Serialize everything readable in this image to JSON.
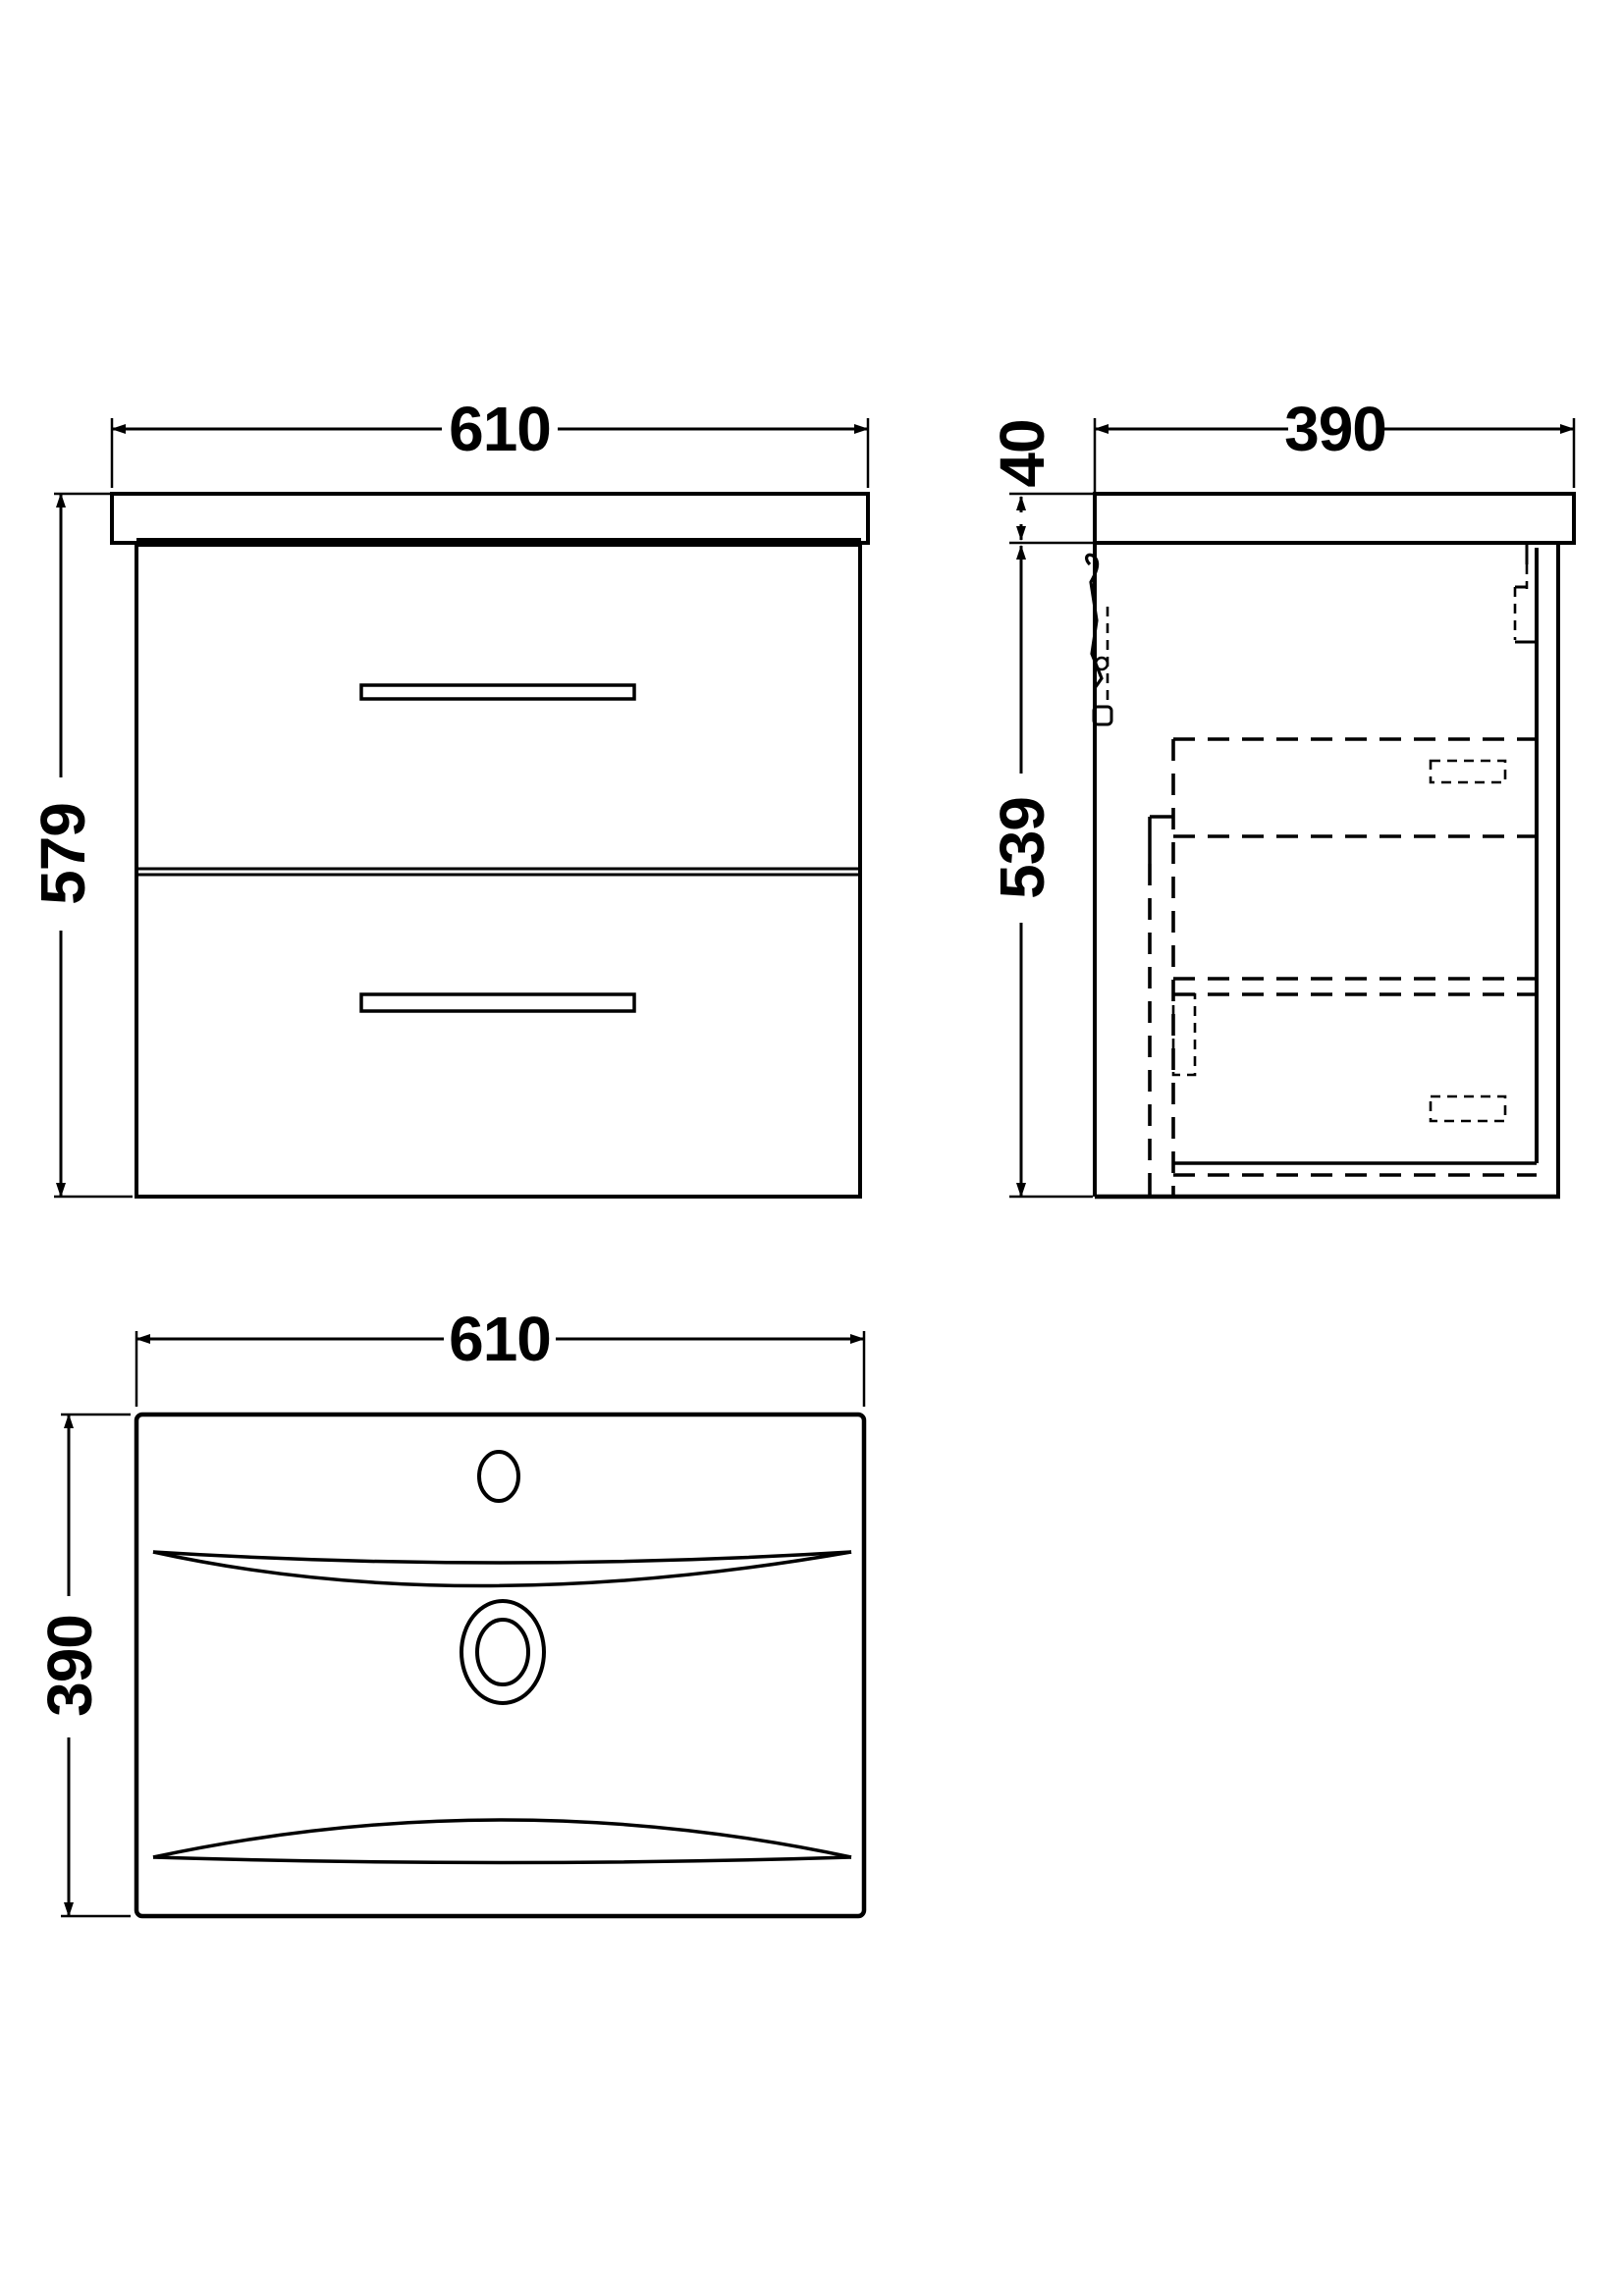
{
  "style": {
    "background_color": "#ffffff",
    "line_color": "#000000",
    "text_color": "#000000"
  },
  "drawing": {
    "description": "vanity-unit-technical-drawing",
    "front_view": {
      "width_mm": "610",
      "height_mm": "579"
    },
    "side_view": {
      "depth_mm": "390",
      "worktop_thickness_mm": "40",
      "cabinet_height_mm": "539"
    },
    "plan_view": {
      "width_mm": "610",
      "depth_mm": "390"
    }
  }
}
